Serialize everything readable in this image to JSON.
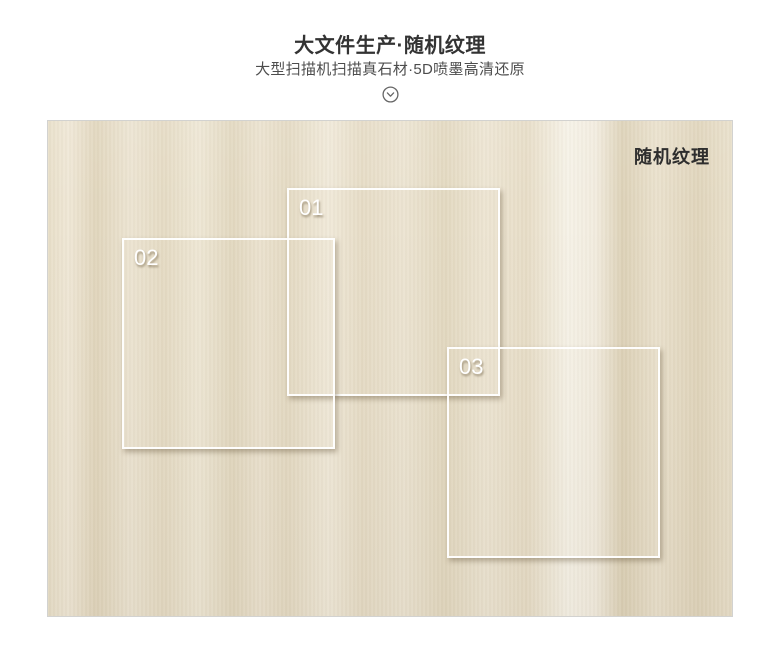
{
  "header": {
    "title": "大文件生产·随机纹理",
    "subtitle": "大型扫描机扫描真石材·5D喷墨高清还原",
    "chevron_icon": "chevron-down-circle-icon"
  },
  "showcase": {
    "corner_label": "随机纹理",
    "regions": [
      {
        "label": "01"
      },
      {
        "label": "02"
      },
      {
        "label": "03"
      }
    ],
    "colors": {
      "marble_base": "#e9e0cb",
      "marble_light": "#f6f2e7",
      "marble_dark": "#ddd2b8",
      "panel_border": "#d2d2d0",
      "region_outline": "#ffffff",
      "region_label_text": "#ffffff",
      "corner_label_text": "#2e2e2e",
      "title_text": "#333333",
      "subtitle_text": "#4d4d4d"
    }
  }
}
